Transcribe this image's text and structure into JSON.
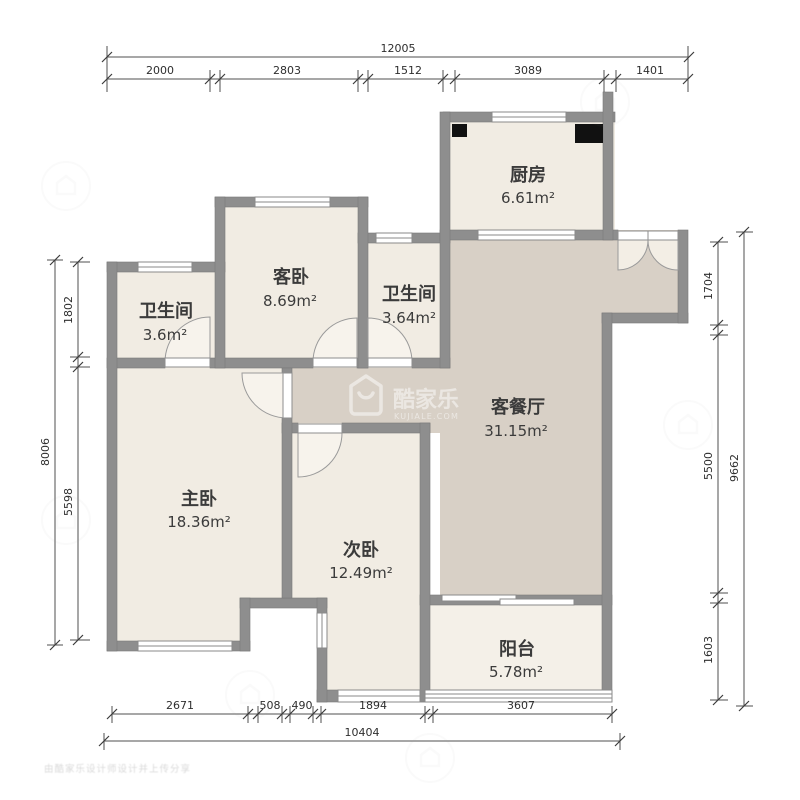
{
  "colors": {
    "wall": "#8e8e8e",
    "room_fill": "#f1ece3",
    "living_fill": "#d8d0c6",
    "balcony_fill": "#f4f0e8",
    "flue": "#111111",
    "dimension_line": "#4f4f4f"
  },
  "rooms": {
    "kitchen": {
      "label": "厨房",
      "area": "6.61m²"
    },
    "guest_bedroom": {
      "label": "客卧",
      "area": "8.69m²"
    },
    "bathroom_main": {
      "label": "卫生间",
      "area": "3.64m²"
    },
    "bathroom_small": {
      "label": "卫生间",
      "area": "3.6m²"
    },
    "living_dining": {
      "label": "客餐厅",
      "area": "31.15m²"
    },
    "master_bedroom": {
      "label": "主卧",
      "area": "18.36m²"
    },
    "second_bedroom": {
      "label": "次卧",
      "area": "12.49m²"
    },
    "balcony": {
      "label": "阳台",
      "area": "5.78m²"
    }
  },
  "dimensions": {
    "top_total": "12005",
    "top_segments": [
      "2000",
      "2803",
      "1512",
      "3089",
      "1401"
    ],
    "bottom_segments": [
      "2671",
      "508",
      "490",
      "1894",
      "3607"
    ],
    "bottom_total": "10404",
    "left_segments": [
      "1802",
      "5598"
    ],
    "left_total": "8006",
    "right_segments": [
      "1704",
      "5500",
      "1603"
    ],
    "right_total": "9662"
  },
  "watermark": {
    "brand": "酷家乐",
    "domain": "KUJIALE.COM"
  },
  "footer_watermark": "由酷家乐设计师设计并上传分享"
}
